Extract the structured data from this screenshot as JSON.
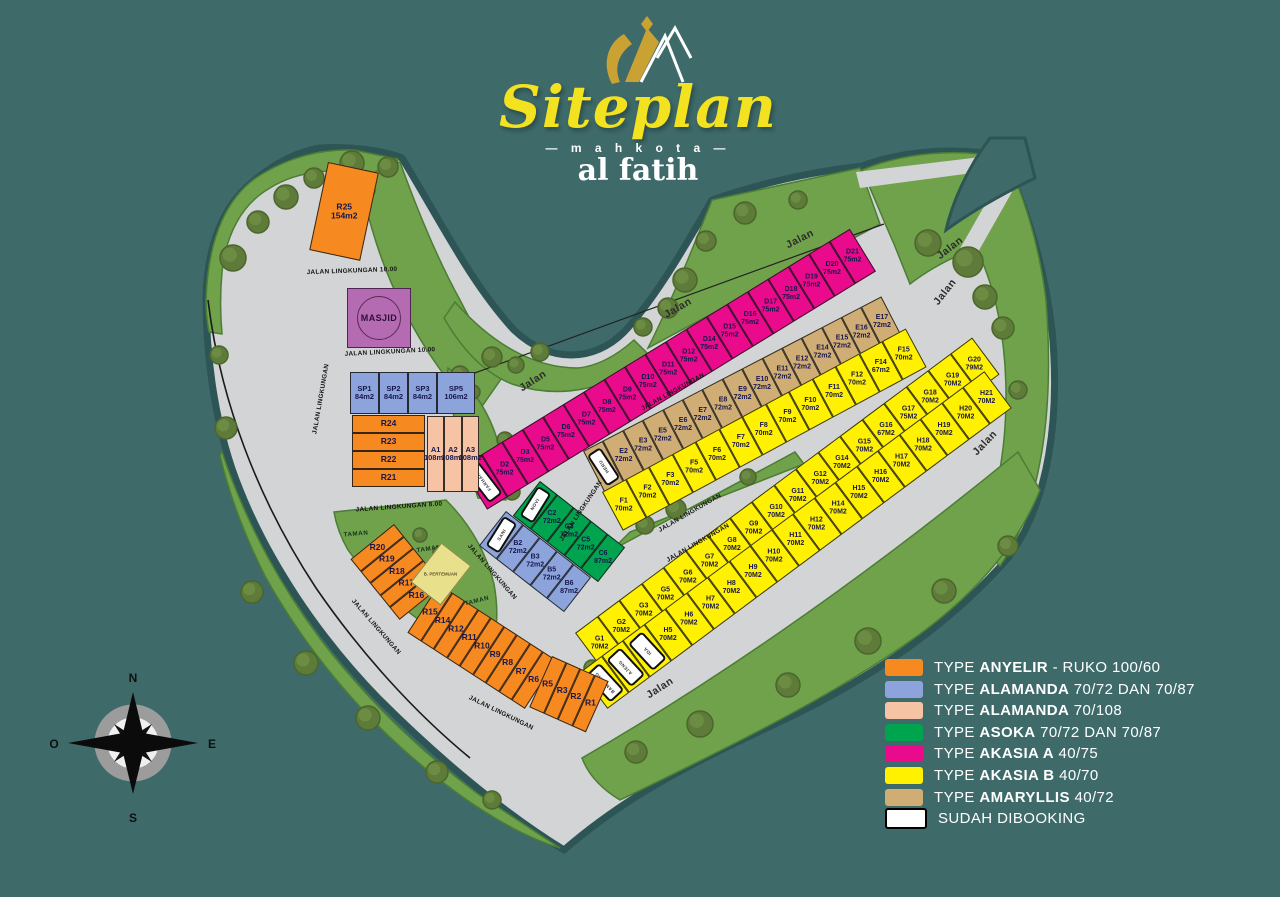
{
  "title": {
    "script": "Siteplan",
    "subtitle": "— m a h k o t a —",
    "brand": "al fatih"
  },
  "compass": {
    "north": "N",
    "east": "E",
    "south": "S",
    "west": "O"
  },
  "facilities": {
    "masjid": "MASJID",
    "hall": "B. PERTEMUAN"
  },
  "type_colors": {
    "anyelir": "#F6891F",
    "alamanda_72": "#8CA4DB",
    "alamanda_108": "#F6C4A4",
    "asoka": "#00A44F",
    "akasia_a": "#EA0A8C",
    "akasia_b": "#FFF100",
    "amaryllis": "#CFAD75",
    "booked": "#FFFFFF"
  },
  "legend": {
    "items": [
      {
        "color": "#F6891F",
        "prefix": "TYPE",
        "name": "ANYELIR",
        "suffix": "- RUKO 100/60"
      },
      {
        "color": "#8CA4DB",
        "prefix": "TYPE",
        "name": "ALAMANDA",
        "suffix": "70/72 DAN 70/87"
      },
      {
        "color": "#F6C4A4",
        "prefix": "TYPE",
        "name": "ALAMANDA",
        "suffix": "70/108"
      },
      {
        "color": "#00A44F",
        "prefix": "TYPE",
        "name": "ASOKA",
        "suffix": "70/72 DAN 70/87"
      },
      {
        "color": "#EA0A8C",
        "prefix": "TYPE",
        "name": "AKASIA A",
        "suffix": "40/75"
      },
      {
        "color": "#FFF100",
        "prefix": "TYPE",
        "name": "AKASIA B",
        "suffix": "40/70"
      },
      {
        "color": "#CFAD75",
        "prefix": "TYPE",
        "name": "AMARYLLIS",
        "suffix": "40/72"
      },
      {
        "color": "#FFFFFF",
        "border": "#000000",
        "prefix": "",
        "name": "",
        "suffix": "SUDAH DIBOOKING"
      }
    ]
  },
  "strips": [
    {
      "name": "block-D",
      "type": "akasia_a",
      "x": 461,
      "y": 467,
      "rot": -31.5,
      "lw": 24,
      "lh": 50,
      "lots": [
        {
          "b": 1,
          "n": "FARHAN"
        },
        [
          "D2",
          "75m2"
        ],
        [
          "D3",
          "75m2"
        ],
        [
          "D5",
          "75m2"
        ],
        [
          "D6",
          "75m2"
        ],
        [
          "D7",
          "75m2"
        ],
        [
          "D8",
          "75m2"
        ],
        [
          "D9",
          "75m2"
        ],
        [
          "D10",
          "75m2"
        ],
        [
          "D11",
          "75m2"
        ],
        [
          "D12",
          "75m2"
        ],
        [
          "D14",
          "75m2"
        ],
        [
          "D15",
          "75m2"
        ],
        [
          "D16",
          "75m2"
        ],
        [
          "D17",
          "75m2"
        ],
        [
          "D18",
          "75m2"
        ],
        [
          "D19",
          "75m2"
        ],
        [
          "D20",
          "75m2"
        ],
        [
          "D21",
          "75m2"
        ]
      ]
    },
    {
      "name": "block-E",
      "type": "amaryllis",
      "x": 583,
      "y": 451,
      "rot": -27.4,
      "lw": 22.4,
      "lh": 46,
      "lots": [
        {
          "b": 1,
          "n": "HERU"
        },
        [
          "E2",
          "72m2"
        ],
        [
          "E3",
          "72m2"
        ],
        [
          "E5",
          "72m2"
        ],
        [
          "E6",
          "72m2"
        ],
        [
          "E7",
          "72m2"
        ],
        [
          "E8",
          "72m2"
        ],
        [
          "E9",
          "72m2"
        ],
        [
          "E10",
          "72m2"
        ],
        [
          "E11",
          "72m2"
        ],
        [
          "E12",
          "72m2"
        ],
        [
          "E14",
          "72m2"
        ],
        [
          "E15",
          "72m2"
        ],
        [
          "E16",
          "72m2"
        ],
        [
          "E17",
          "72m2"
        ]
      ]
    },
    {
      "name": "block-F",
      "type": "akasia_b",
      "x": 602,
      "y": 492,
      "rot": -28.3,
      "lw": 26.5,
      "lh": 44,
      "lots": [
        [
          "F1",
          "70m2"
        ],
        [
          "F2",
          "70m2"
        ],
        [
          "F3",
          "70m2"
        ],
        [
          "F5",
          "70m2"
        ],
        [
          "F6",
          "70m2"
        ],
        [
          "F7",
          "70m2"
        ],
        [
          "F8",
          "70m2"
        ],
        [
          "F9",
          "70m2"
        ],
        [
          "F10",
          "70m2"
        ],
        [
          "F11",
          "70m2"
        ],
        [
          "F12",
          "70m2"
        ],
        [
          "F14",
          "67m2"
        ],
        [
          "F15",
          "70m2"
        ]
      ]
    },
    {
      "name": "block-G",
      "type": "akasia_b",
      "x": 575,
      "y": 633,
      "rot": -36.65,
      "lw": 27.5,
      "lh": 46,
      "lots": [
        [
          "G1",
          "70M2"
        ],
        [
          "G2",
          "70M2"
        ],
        [
          "G3",
          "70M2"
        ],
        [
          "G5",
          "70M2"
        ],
        [
          "G6",
          "70M2"
        ],
        [
          "G7",
          "70M2"
        ],
        [
          "G8",
          "70M2"
        ],
        [
          "G9",
          "70M2"
        ],
        [
          "G10",
          "70M2"
        ],
        [
          "G11",
          "70M2"
        ],
        [
          "G12",
          "70M2"
        ],
        [
          "G14",
          "70M2"
        ],
        [
          "G15",
          "70M2"
        ],
        [
          "G16",
          "67M2"
        ],
        [
          "G17",
          "75M2"
        ],
        [
          "G18",
          "70M2"
        ],
        [
          "G19",
          "70M2"
        ],
        [
          "G20",
          "79M2"
        ]
      ]
    },
    {
      "name": "block-H",
      "type": "akasia_b",
      "x": 580,
      "y": 672,
      "rot": -36.65,
      "lw": 26.5,
      "lh": 46,
      "lots": [
        {
          "b": 1,
          "n": "BAMBANG"
        },
        {
          "b": 1,
          "n": "AJENG"
        },
        {
          "b": 1,
          "n": "IDA"
        },
        [
          "H5",
          "70M2"
        ],
        [
          "H6",
          "70M2"
        ],
        [
          "H7",
          "70M2"
        ],
        [
          "H8",
          "70M2"
        ],
        [
          "H9",
          "70M2"
        ],
        [
          "H10",
          "70M2"
        ],
        [
          "H11",
          "70M2"
        ],
        [
          "H12",
          "70M2"
        ],
        [
          "H14",
          "70M2"
        ],
        [
          "H15",
          "70M2"
        ],
        [
          "H16",
          "70M2"
        ],
        [
          "H17",
          "70M2"
        ],
        [
          "H18",
          "70M2"
        ],
        [
          "H19",
          "70M2"
        ],
        [
          "H20",
          "70M2"
        ],
        [
          "H21",
          "70M2"
        ]
      ]
    },
    {
      "name": "block-B",
      "type": "alamanda_72",
      "x": 506,
      "y": 511,
      "rot": 38,
      "lw": 21.5,
      "lh": 44,
      "lots": [
        {
          "b": 1,
          "n": "SANI"
        },
        [
          "B2",
          "72m2"
        ],
        [
          "B3",
          "72m2"
        ],
        [
          "B5",
          "72m2"
        ],
        [
          "B6",
          "87m2"
        ]
      ]
    },
    {
      "name": "block-C",
      "type": "asoka",
      "x": 540,
      "y": 481,
      "rot": 38,
      "lw": 21.5,
      "lh": 44,
      "lots": [
        {
          "b": 1,
          "n": "NOVI"
        },
        [
          "C2",
          "72m2"
        ],
        [
          "C3",
          "72m2"
        ],
        [
          "C5",
          "72m2"
        ],
        [
          "C6",
          "87m2"
        ]
      ]
    },
    {
      "name": "block-SP",
      "type": "alamanda_72",
      "x": 350,
      "y": 372,
      "rot": 0,
      "lw": 29,
      "lh": 42,
      "fs": 7.5,
      "lots": [
        [
          "SP1",
          "84m2"
        ],
        [
          "SP2",
          "84m2"
        ],
        [
          "SP3",
          "84m2"
        ],
        [
          "SP5",
          "106m2",
          38
        ]
      ]
    },
    {
      "name": "block-R24-21",
      "type": "anyelir",
      "x": 352,
      "y": 415,
      "rot": 0,
      "dir": "v",
      "lw": 73,
      "lh": 18,
      "fs": 8.5,
      "lots": [
        [
          "R24"
        ],
        [
          "R23"
        ],
        [
          "R22"
        ],
        [
          "R21"
        ]
      ]
    },
    {
      "name": "block-A",
      "type": "alamanda_108",
      "x": 427,
      "y": 416,
      "rot": 0,
      "lw": 17.3,
      "lh": 76,
      "fs": 7.5,
      "lots": [
        [
          "A1",
          "108m2"
        ],
        [
          "A2",
          "108m2"
        ],
        [
          "A3",
          "108m2"
        ]
      ]
    },
    {
      "name": "lot-R25",
      "type": "anyelir",
      "x": 328,
      "y": 162,
      "rot": 12,
      "lw": 52,
      "lh": 90,
      "fs": 8.5,
      "lots": [
        [
          "R25",
          "154m2"
        ]
      ]
    },
    {
      "name": "block-R20-16",
      "type": "anyelir",
      "x": 394,
      "y": 524,
      "rot": 51,
      "lw": 15.5,
      "lh": 56,
      "fs": 8.5,
      "lots": [
        [
          "R20"
        ],
        [
          "R19"
        ],
        [
          "R18"
        ],
        [
          "R17"
        ],
        [
          "R16"
        ]
      ]
    },
    {
      "name": "block-R15-6",
      "type": "anyelir",
      "x": 439,
      "y": 584,
      "rot": 33,
      "lw": 15.5,
      "lh": 58,
      "fs": 8.5,
      "lots": [
        [
          "R15"
        ],
        [
          "R14"
        ],
        [
          "R12"
        ],
        [
          "R11"
        ],
        [
          "R10"
        ],
        [
          "R9"
        ],
        [
          "R8"
        ],
        [
          "R7"
        ],
        [
          "R6"
        ]
      ]
    },
    {
      "name": "block-R5-1",
      "type": "anyelir",
      "x": 552,
      "y": 656,
      "rot": 24,
      "lw": 15.5,
      "lh": 56,
      "fs": 8.5,
      "lots": [
        [
          "R5"
        ],
        [
          "R3"
        ],
        [
          "R2"
        ],
        [
          "R1"
        ]
      ]
    }
  ],
  "road_labels": [
    {
      "t": "JALAN LINGKUNGAN 10.00",
      "x": 352,
      "y": 271,
      "r": -2,
      "c": "jl"
    },
    {
      "t": "JALAN LINGKUNGAN 10.00",
      "x": 390,
      "y": 352,
      "r": -3,
      "c": "jl"
    },
    {
      "t": "JALAN LINGKUNGAN 8.00",
      "x": 399,
      "y": 507,
      "r": -4,
      "c": "jl"
    },
    {
      "t": "JALAN LINGKUNGAN",
      "x": 321,
      "y": 399,
      "r": -80,
      "c": "jl"
    },
    {
      "t": "JALAN LINGKUNGAN",
      "x": 376,
      "y": 627,
      "r": 49,
      "c": "jl"
    },
    {
      "t": "JALAN LINGKUNGAN",
      "x": 492,
      "y": 572,
      "r": 49,
      "c": "jl"
    },
    {
      "t": "JALAN LINGKUNGAN",
      "x": 501,
      "y": 713,
      "r": 26,
      "c": "jl"
    },
    {
      "t": "JALAN LINGKUNGAN",
      "x": 581,
      "y": 511,
      "r": -56,
      "c": "jl"
    },
    {
      "t": "JALAN LINGKUNGAN",
      "x": 673,
      "y": 392,
      "r": -29,
      "c": "jl"
    },
    {
      "t": "JALAN LINGKUNGAN",
      "x": 690,
      "y": 513,
      "r": -30,
      "c": "jl"
    },
    {
      "t": "JALAN LINGKUNGAN",
      "x": 698,
      "y": 543,
      "r": -30,
      "c": "jl"
    },
    {
      "t": "Jalan",
      "x": 533,
      "y": 381,
      "r": -33,
      "c": "jalan"
    },
    {
      "t": "Jalan",
      "x": 678,
      "y": 308,
      "r": -30,
      "c": "jalan"
    },
    {
      "t": "Jalan",
      "x": 800,
      "y": 239,
      "r": -27,
      "c": "jalan"
    },
    {
      "t": "Jalan",
      "x": 950,
      "y": 248,
      "r": -38,
      "c": "jalan"
    },
    {
      "t": "Jalan",
      "x": 945,
      "y": 292,
      "r": -52,
      "c": "jalan"
    },
    {
      "t": "Jalan",
      "x": 985,
      "y": 443,
      "r": -46,
      "c": "jalan"
    },
    {
      "t": "Jalan",
      "x": 660,
      "y": 688,
      "r": -33,
      "c": "jalan"
    },
    {
      "t": "TAMAN",
      "x": 356,
      "y": 534,
      "r": -5,
      "c": "taman"
    },
    {
      "t": "TAMAN",
      "x": 429,
      "y": 549,
      "r": -8,
      "c": "taman"
    },
    {
      "t": "TAMAN",
      "x": 477,
      "y": 601,
      "r": -14,
      "c": "taman"
    }
  ],
  "decor": {
    "water": "#3E6A6A",
    "shore": "#2E5556",
    "land": "#D3D4D6",
    "grass": "#6FA24B",
    "grass_edge": "#4C7D35",
    "trees": [
      [
        233,
        258,
        13
      ],
      [
        258,
        222,
        11
      ],
      [
        286,
        197,
        12
      ],
      [
        314,
        178,
        10
      ],
      [
        352,
        163,
        12
      ],
      [
        388,
        167,
        10
      ],
      [
        366,
        190,
        9
      ],
      [
        219,
        355,
        9
      ],
      [
        226,
        428,
        11
      ],
      [
        685,
        280,
        12
      ],
      [
        706,
        241,
        10
      ],
      [
        668,
        308,
        10
      ],
      [
        745,
        213,
        11
      ],
      [
        798,
        200,
        9
      ],
      [
        643,
        327,
        9
      ],
      [
        540,
        352,
        9
      ],
      [
        492,
        357,
        10
      ],
      [
        516,
        365,
        8
      ],
      [
        928,
        243,
        13
      ],
      [
        968,
        262,
        15
      ],
      [
        985,
        297,
        12
      ],
      [
        1003,
        328,
        11
      ],
      [
        1018,
        390,
        9
      ],
      [
        460,
        375,
        9
      ],
      [
        473,
        392,
        7
      ],
      [
        481,
        464,
        8
      ],
      [
        505,
        440,
        8
      ],
      [
        512,
        492,
        8
      ],
      [
        645,
        525,
        9
      ],
      [
        676,
        509,
        10
      ],
      [
        748,
        477,
        8
      ],
      [
        700,
        724,
        13
      ],
      [
        788,
        685,
        12
      ],
      [
        868,
        641,
        13
      ],
      [
        944,
        591,
        12
      ],
      [
        1008,
        546,
        10
      ],
      [
        636,
        752,
        11
      ],
      [
        252,
        592,
        11
      ],
      [
        306,
        663,
        12
      ],
      [
        368,
        718,
        12
      ],
      [
        437,
        772,
        11
      ],
      [
        492,
        800,
        9
      ],
      [
        420,
        535,
        7
      ],
      [
        440,
        553,
        7
      ],
      [
        470,
        630,
        8
      ],
      [
        592,
        668,
        8
      ]
    ]
  }
}
